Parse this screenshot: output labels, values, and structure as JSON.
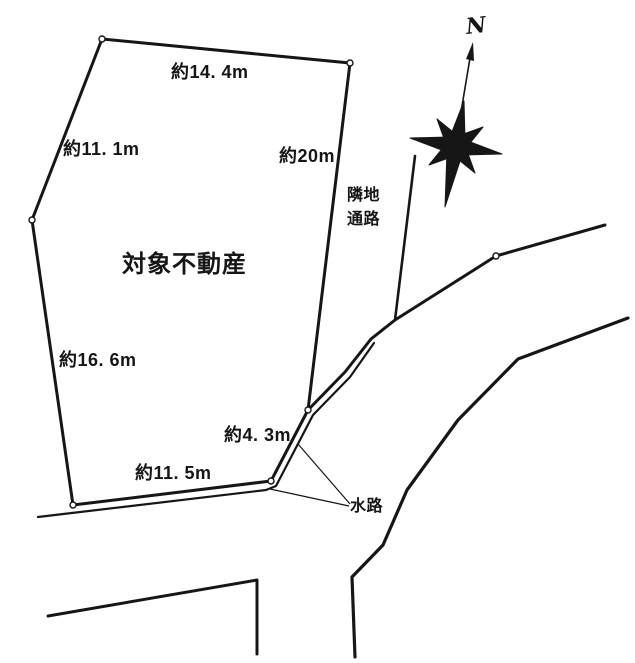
{
  "property": {
    "name": "対象不動産",
    "edge_labels": {
      "top": "約14. 4m",
      "upper_left": "約11. 1m",
      "right": "約20m",
      "left": "約16. 6m",
      "lower_right": "約4. 3m",
      "bottom": "約11. 5m"
    }
  },
  "annotations": {
    "neighbor_path": [
      "隣地",
      "通路"
    ],
    "waterway": "水路",
    "north_mark": "N"
  },
  "colors": {
    "ink": "#161616",
    "paper": "#ffffff"
  }
}
